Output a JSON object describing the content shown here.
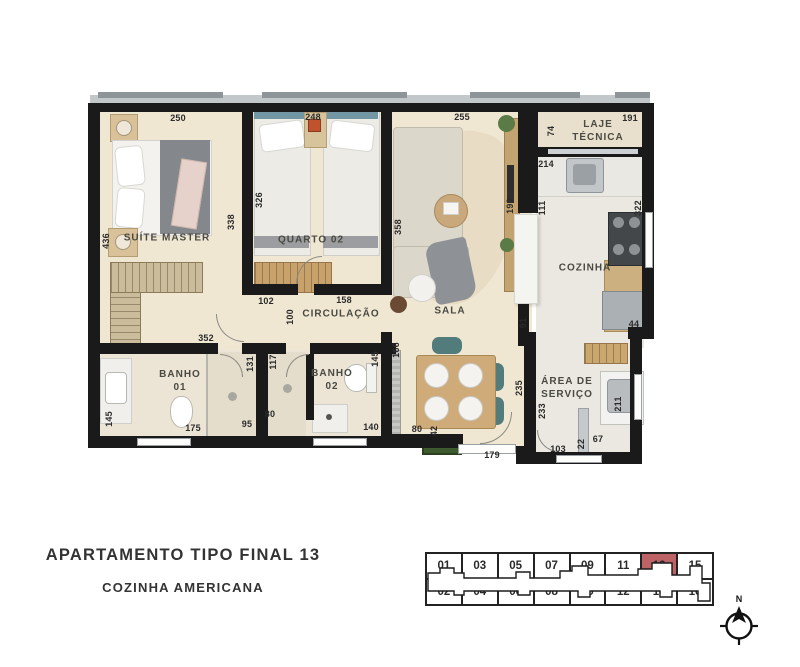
{
  "title": "APARTAMENTO TIPO FINAL 13",
  "subtitle": "COZINHA AMERICANA",
  "rooms": {
    "suite_master": "SUÍTE MASTER",
    "quarto_02": "QUARTO 02",
    "sala": "SALA",
    "circulacao": "CIRCULAÇÃO",
    "cozinha": "COZINHA",
    "laje_tecnica": "LAJE\nTÉCNICA",
    "banho_01": "BANHO\n01",
    "banho_02": "BANHO\n02",
    "area_servico": "ÁREA DE\nSERVIÇO"
  },
  "dims": {
    "suite_width": "250",
    "quarto_width": "248",
    "sala_width": "255",
    "laje_width": "191",
    "laje_depth": "74",
    "suite_side": "436",
    "suite_wall": "338",
    "quarto_side": "326",
    "sala_side": "358",
    "cozinha_top": "214",
    "cozinha_left": "111",
    "cozinha_right": "322",
    "counter": "190",
    "door_left": "102",
    "door_right": "158",
    "hall": "100",
    "banho_span": "352",
    "banho1_inner": "131",
    "banho2_wall": "117",
    "banho1_side": "145",
    "banho1_width": "175",
    "shower1": "95",
    "shower2": "80",
    "banho2_width": "140",
    "banho2_side": "145",
    "passage": "166",
    "dining": "80",
    "niche": "42",
    "entry": "179",
    "cozinha_wall": "91",
    "servico_wall": "235",
    "servico_side": "233",
    "servico_width": "103",
    "servico_door": "22",
    "servico_step": "67",
    "servico_right": "211",
    "fridge_gap": "44"
  },
  "keyplan": {
    "row1": [
      "01",
      "03",
      "05",
      "07",
      "09",
      "11",
      "13",
      "15"
    ],
    "row2": [
      "02",
      "04",
      "06",
      "08",
      "10",
      "12",
      "14",
      "16"
    ],
    "highlighted": "13"
  },
  "compass": {
    "north": "N"
  },
  "colors": {
    "highlight": "#bd6366",
    "wall": "#1a1a1a",
    "floor": "#f0e7d3",
    "tile": "#eae8e0"
  }
}
